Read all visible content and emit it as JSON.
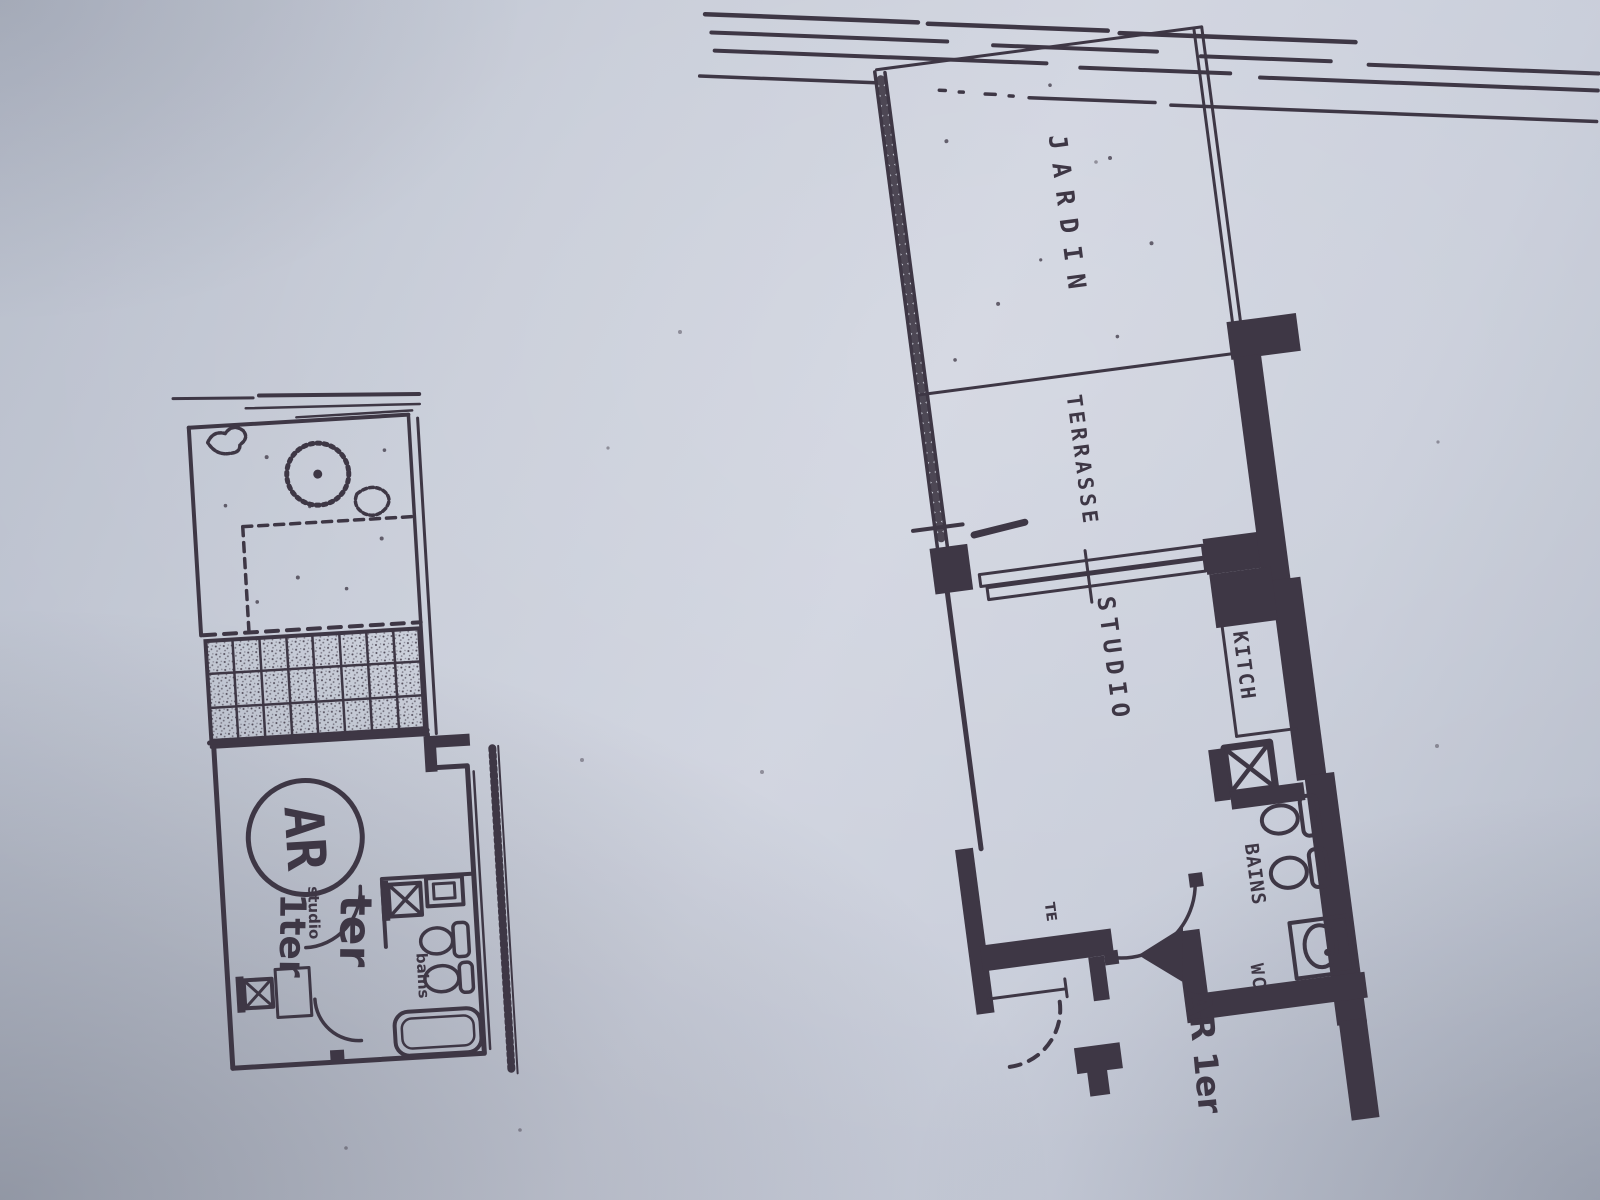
{
  "colors": {
    "ink": "#3e3745",
    "paper_light": "#ced2de",
    "paper_dark": "#b2b8c6"
  },
  "large_plan": {
    "labels": {
      "jardin": "JARDIN",
      "terrasse": "TERRASSE",
      "studio": "STUDIO",
      "kitchen": "KITCH",
      "bains": "BAINS",
      "wc": "WC",
      "entrance": "AR 1er",
      "radiator": "TE"
    }
  },
  "small_plan": {
    "labels": {
      "badge": "AR",
      "ter": "ter",
      "studio": "studio",
      "unit": "1ter",
      "bains": "bains"
    }
  }
}
